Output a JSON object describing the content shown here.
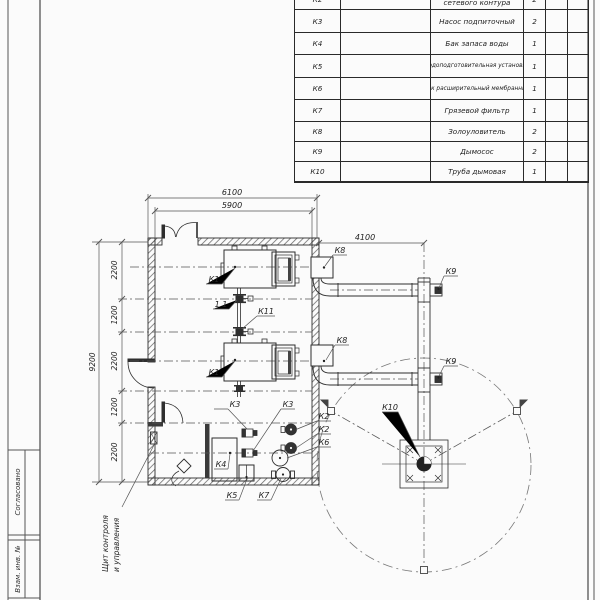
{
  "table": {
    "rows": [
      {
        "code": "К2",
        "name": "сетевого контура",
        "qty": "2"
      },
      {
        "code": "К3",
        "name": "Насос подпиточный",
        "qty": "2"
      },
      {
        "code": "К4",
        "name": "Бак запаса воды",
        "qty": "1"
      },
      {
        "code": "К5",
        "name": "Водоподготовительная установка",
        "qty": "1"
      },
      {
        "code": "К6",
        "name": "Бак расширительный мембранный",
        "qty": "1"
      },
      {
        "code": "К7",
        "name": "Грязевой фильтр",
        "qty": "1"
      },
      {
        "code": "К8",
        "name": "Золоуловитель",
        "qty": "2"
      },
      {
        "code": "К9",
        "name": "Дымосос",
        "qty": "2"
      },
      {
        "code": "К10",
        "name": "Труба дымовая",
        "qty": "1"
      }
    ]
  },
  "plan": {
    "dims": {
      "total_w": "6100",
      "inner_w": "5900",
      "flue_w": "4100",
      "total_h": "9200",
      "seg_a": "2200",
      "seg_b": "1200",
      "seg_c": "2200",
      "seg_d": "1200",
      "seg_e": "2200"
    },
    "tags": {
      "k1": "К1",
      "v11": "1.1",
      "k11": "К11",
      "k2": "К2",
      "k3": "К3",
      "k4": "К4",
      "k5": "К5",
      "k6": "К6",
      "k7": "К7",
      "k8": "К8",
      "k9": "К9",
      "k10": "К10"
    },
    "note": {
      "line1": "Щит контроля",
      "line2": "и управления"
    }
  },
  "stamp": {
    "agreed": "Согласовано",
    "inv": "Взам. инв. №"
  }
}
